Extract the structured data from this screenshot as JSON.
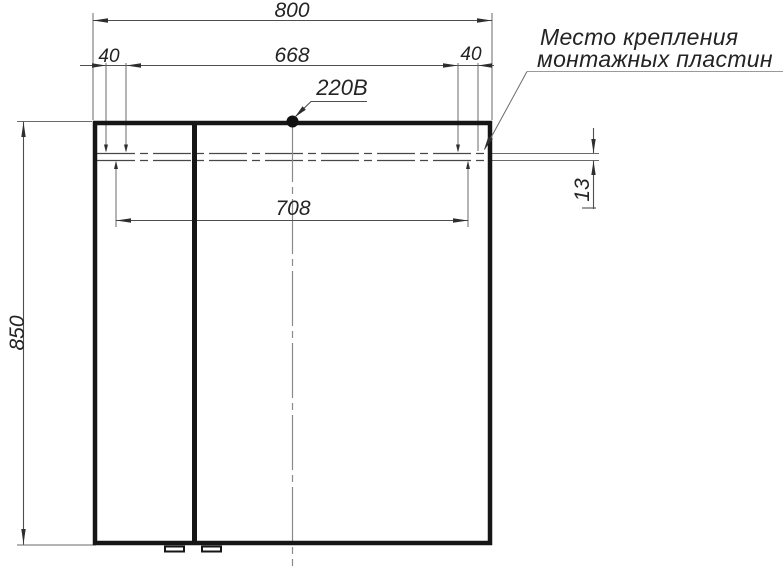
{
  "colors": {
    "ink": "#161616",
    "dimension_line": "#4e4e4e",
    "centerline": "#8a8a8a",
    "note_leader": "#9a9a9a",
    "background": "#ffffff"
  },
  "dimensions": {
    "overall_width": "800",
    "plate_offset_left": "40",
    "between_plates": "668",
    "plate_offset_right": "40",
    "plate_centers_span": "708",
    "overall_height": "850",
    "plate_height": "13"
  },
  "callouts": {
    "power": "220В",
    "note_line1": "Место крепления",
    "note_line2": "монтажных пластин"
  }
}
